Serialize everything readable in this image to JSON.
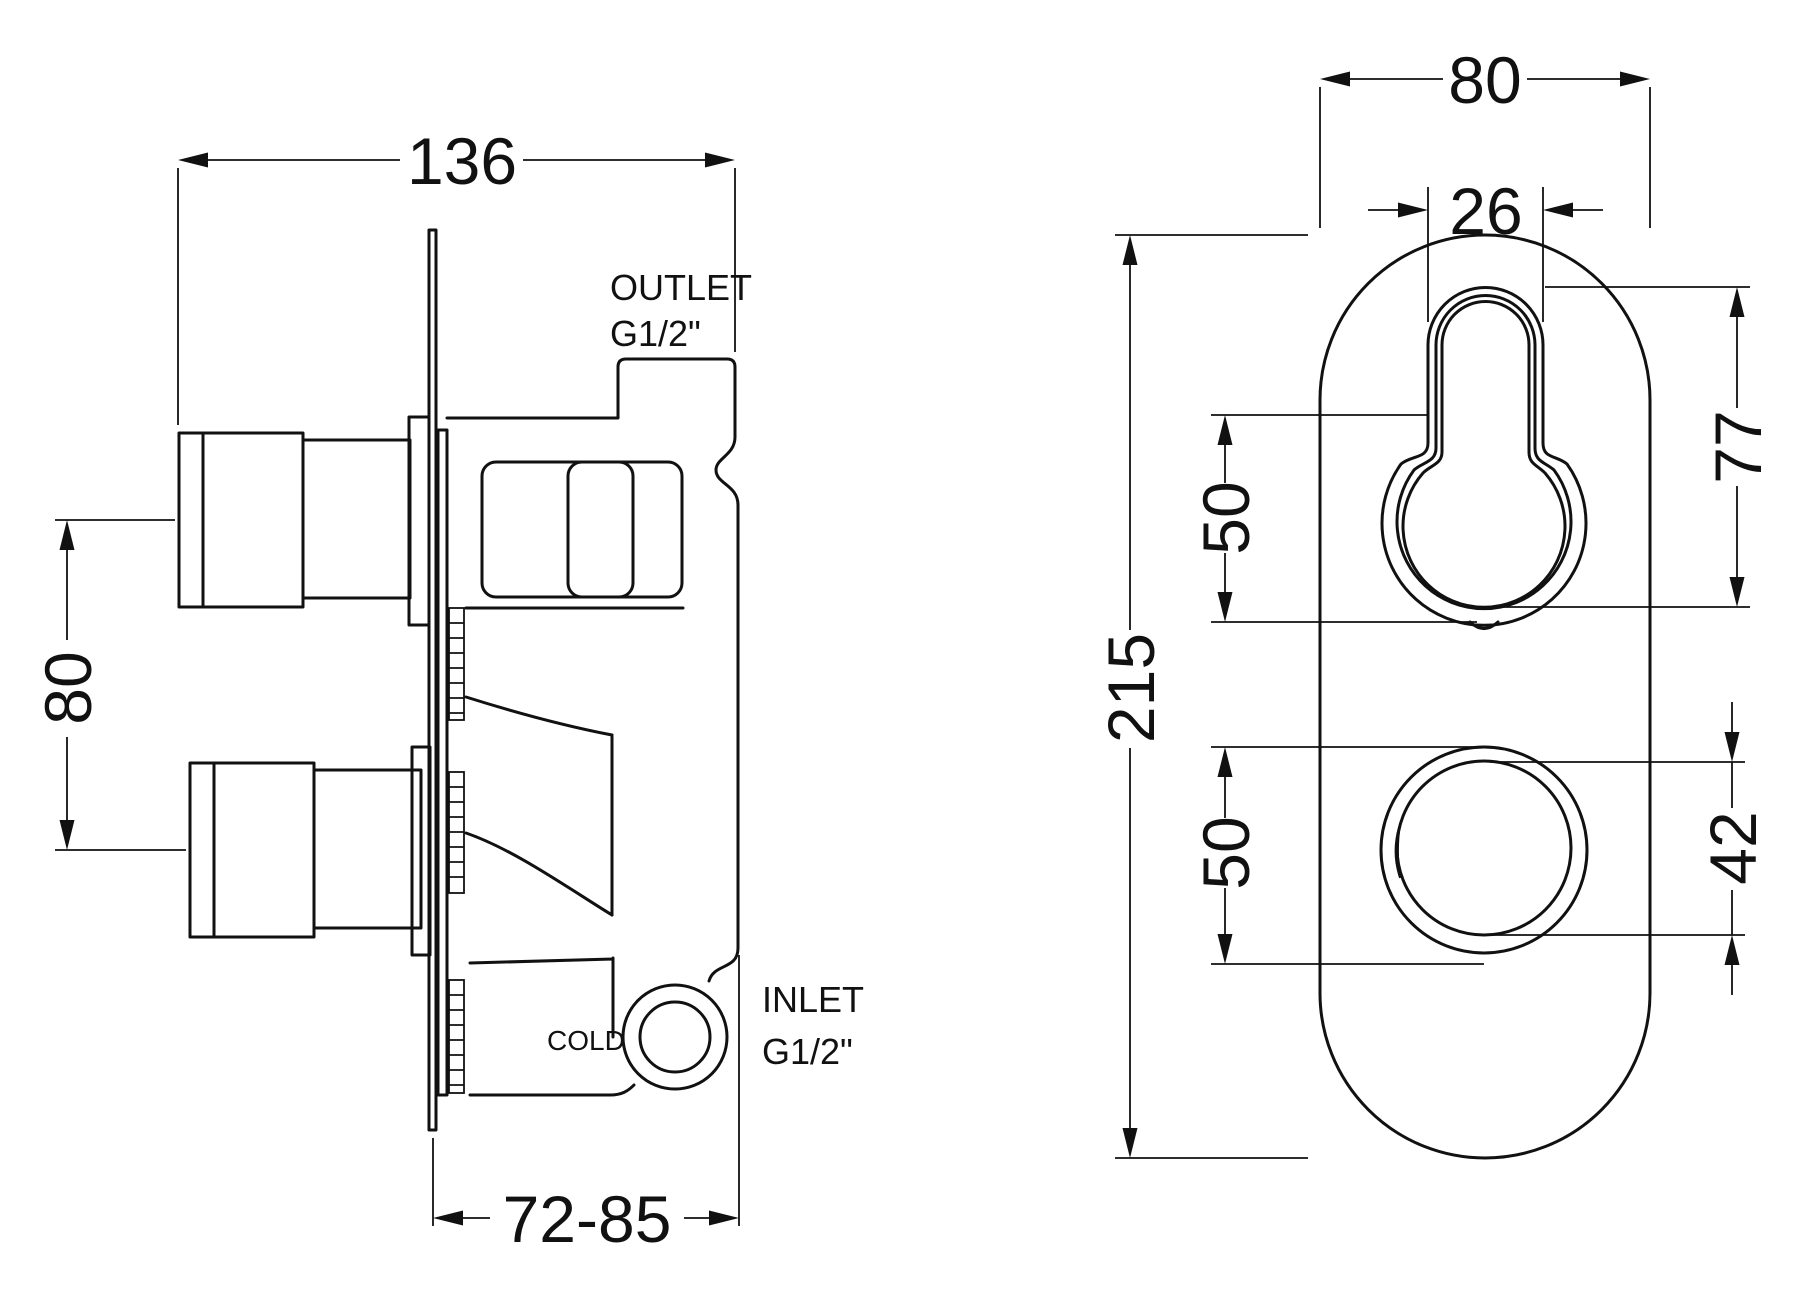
{
  "drawing": {
    "ink_color": "#111111",
    "background_color": "#ffffff",
    "left_view": {
      "labels": {
        "outlet_line1": "OUTLET",
        "outlet_line2": "G1/2\"",
        "inlet_line1": "INLET",
        "inlet_line2": "G1/2\"",
        "cold": "COLD"
      },
      "dimensions": {
        "total_width": "136",
        "handle_spacing": "80",
        "depth_range": "72-85"
      }
    },
    "right_view": {
      "dimensions": {
        "plate_width": "80",
        "slot_width": "26",
        "plate_height": "215",
        "top_control_offset": "50",
        "bottom_control_offset": "50",
        "top_control_height": "77",
        "bottom_control_diameter": "42"
      }
    }
  }
}
